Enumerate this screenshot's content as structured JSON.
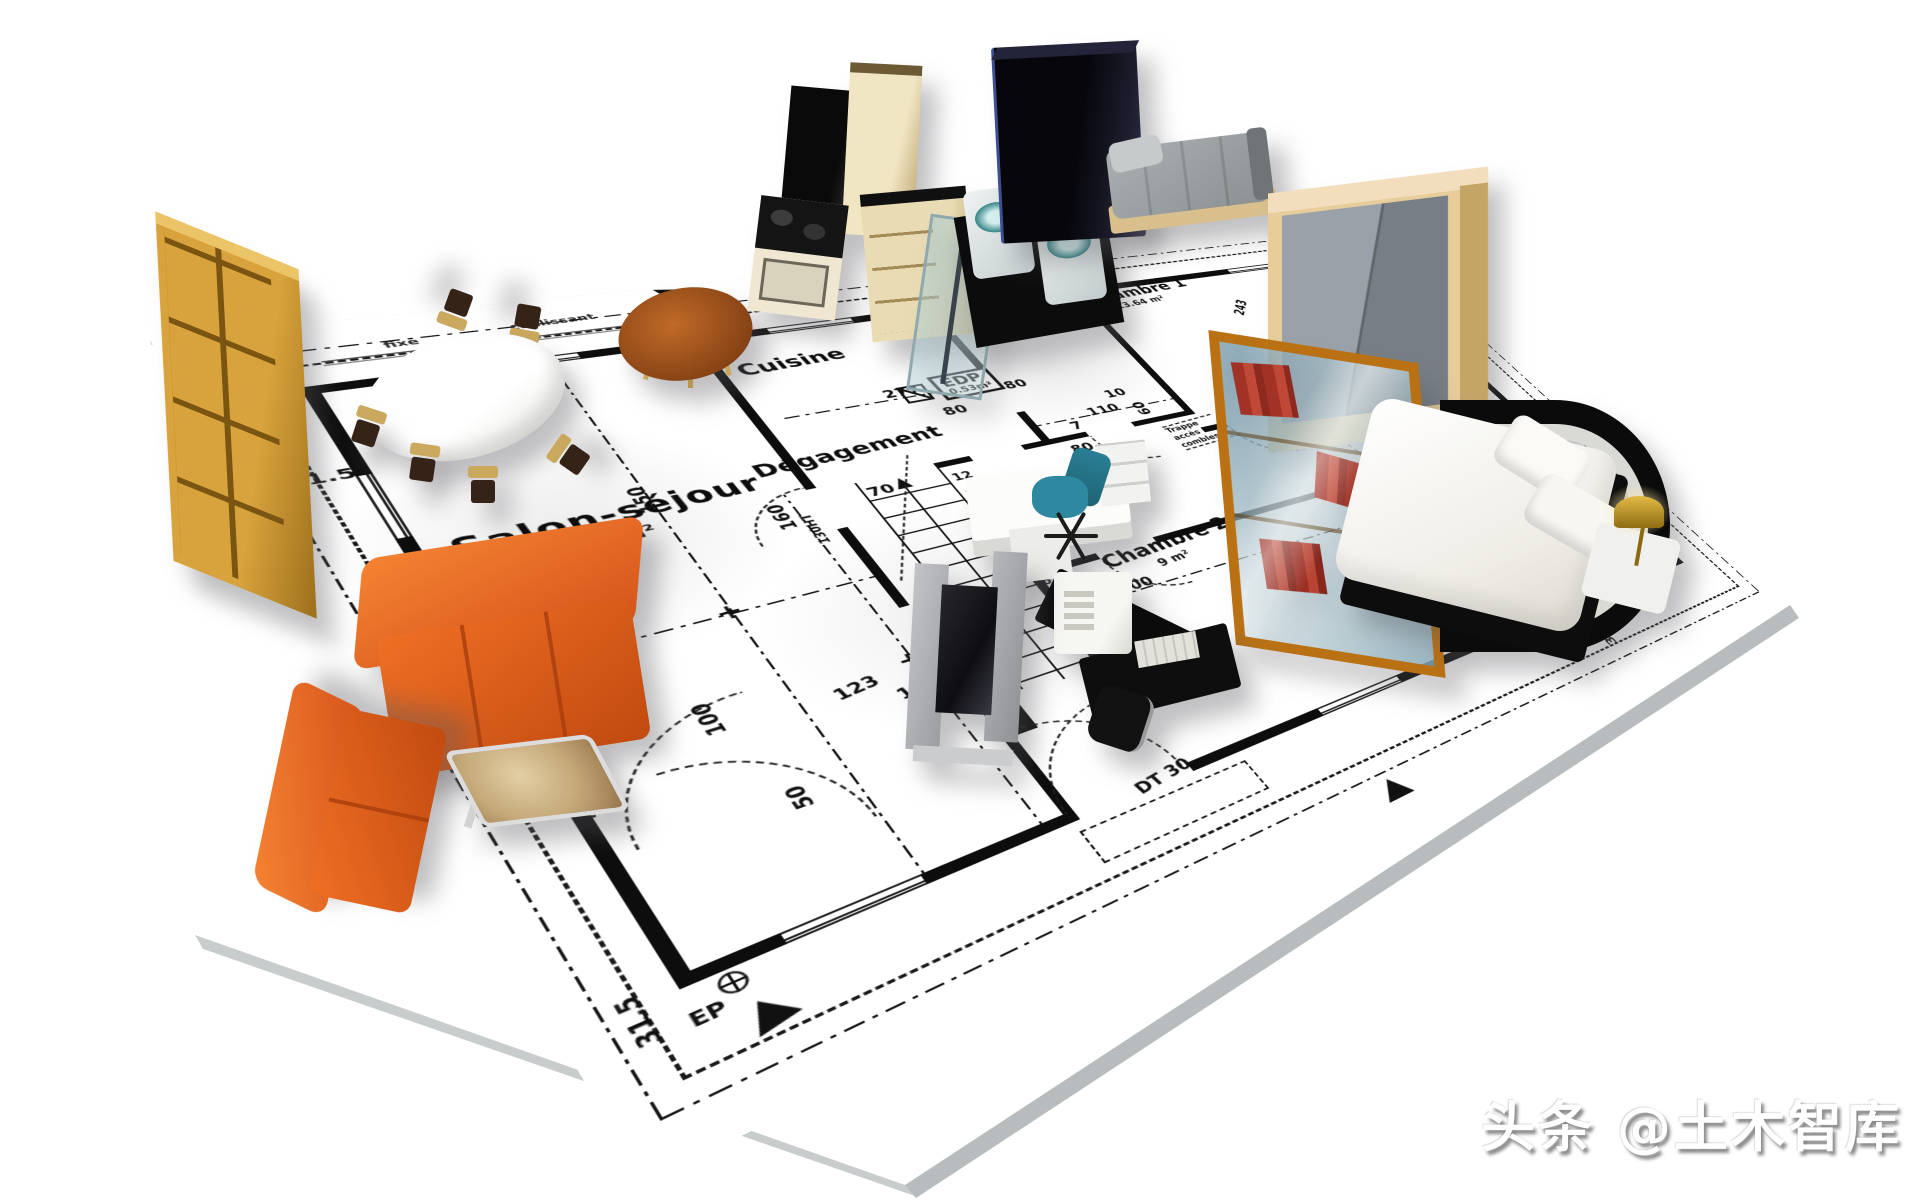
{
  "watermark": {
    "text": "头条 @土木智库"
  },
  "colors": {
    "ink": "#111111",
    "sheet": "#ffffff",
    "sheet_edge": "#b9bcbe",
    "sofa_orange": "#e0581a",
    "wood_tan": "#c8922f",
    "table_wood": "#9a4f1e",
    "office_chair_teal": "#2e89a0",
    "basin_teal": "#2e8084",
    "lamp_gold": "#c9a32a",
    "vitrine_frame": "#b97114",
    "wardrobe_doors": "#8a9199",
    "kitchen_cream": "#e9dcb4"
  },
  "plan": {
    "rooms": [
      {
        "name": "salon-sejour",
        "label": "Salon-séjour",
        "area": "42.19 m²"
      },
      {
        "name": "cuisine",
        "label": "Cuisine"
      },
      {
        "name": "chambre-1",
        "label": "Chambre 1",
        "area": "13.64 m²"
      },
      {
        "name": "chambre-2",
        "label": "Chambre 2",
        "area": "9 m²"
      },
      {
        "name": "degagement",
        "label": "Dégagement"
      },
      {
        "name": "bains",
        "label": "Bains",
        "area": "2 m²"
      },
      {
        "name": "edp",
        "label": "EDP",
        "area": "0.53m²"
      }
    ],
    "dimensions": [
      "31.5",
      "31.5",
      "150",
      "277",
      "80",
      "80",
      "80",
      "110",
      "7",
      "10",
      "243",
      "60",
      "240",
      "300",
      "16.5",
      "123",
      "18.5",
      "100",
      "50",
      "37",
      "70",
      "160",
      "130HT",
      "817",
      "31.5",
      "31.5",
      "243"
    ],
    "stairs": [
      "12",
      "11",
      "10",
      "9",
      "8",
      "7",
      "6",
      "5",
      "4",
      "3",
      "2",
      "1"
    ],
    "annotations": {
      "trappe": "Trappe accès combles",
      "fixe": "fixe",
      "coulissant": "coulissant",
      "dt30": "DT 30",
      "dt22": "DT 22",
      "ep": "EP"
    }
  },
  "furniture": [
    {
      "name": "bookshelf",
      "color": "#c8922f"
    },
    {
      "name": "dining-table",
      "color": "#ffffff"
    },
    {
      "name": "dining-chair",
      "color": "#caa85e"
    },
    {
      "name": "kitchen-round-table",
      "color": "#9a4f1e"
    },
    {
      "name": "kitchen-cabinets",
      "color": "#e9dcb4"
    },
    {
      "name": "kitchen-appliance",
      "color": "#0a0a0a"
    },
    {
      "name": "shower-glass",
      "color": "#a5c8d0"
    },
    {
      "name": "washbasin",
      "color": "#2e8084"
    },
    {
      "name": "dark-armoire",
      "color": "#14141c"
    },
    {
      "name": "gray-daybed",
      "color": "#9aa0a2"
    },
    {
      "name": "wardrobe",
      "color": "#8a9199"
    },
    {
      "name": "display-cabinet",
      "color": "#b97114"
    },
    {
      "name": "double-bed",
      "color": "#f5f4ef"
    },
    {
      "name": "bedside-lamp",
      "color": "#c9a32a"
    },
    {
      "name": "office-desk",
      "color": "#fcfcfb"
    },
    {
      "name": "office-chair",
      "color": "#2e89a0"
    },
    {
      "name": "computer-desk",
      "color": "#0b0b0b"
    },
    {
      "name": "tv-unit",
      "color": "#b0b2b6"
    },
    {
      "name": "sofa-large",
      "color": "#e0581a"
    },
    {
      "name": "sofa-small",
      "color": "#e0581a"
    },
    {
      "name": "coffee-table",
      "color": "#c9b089"
    }
  ]
}
